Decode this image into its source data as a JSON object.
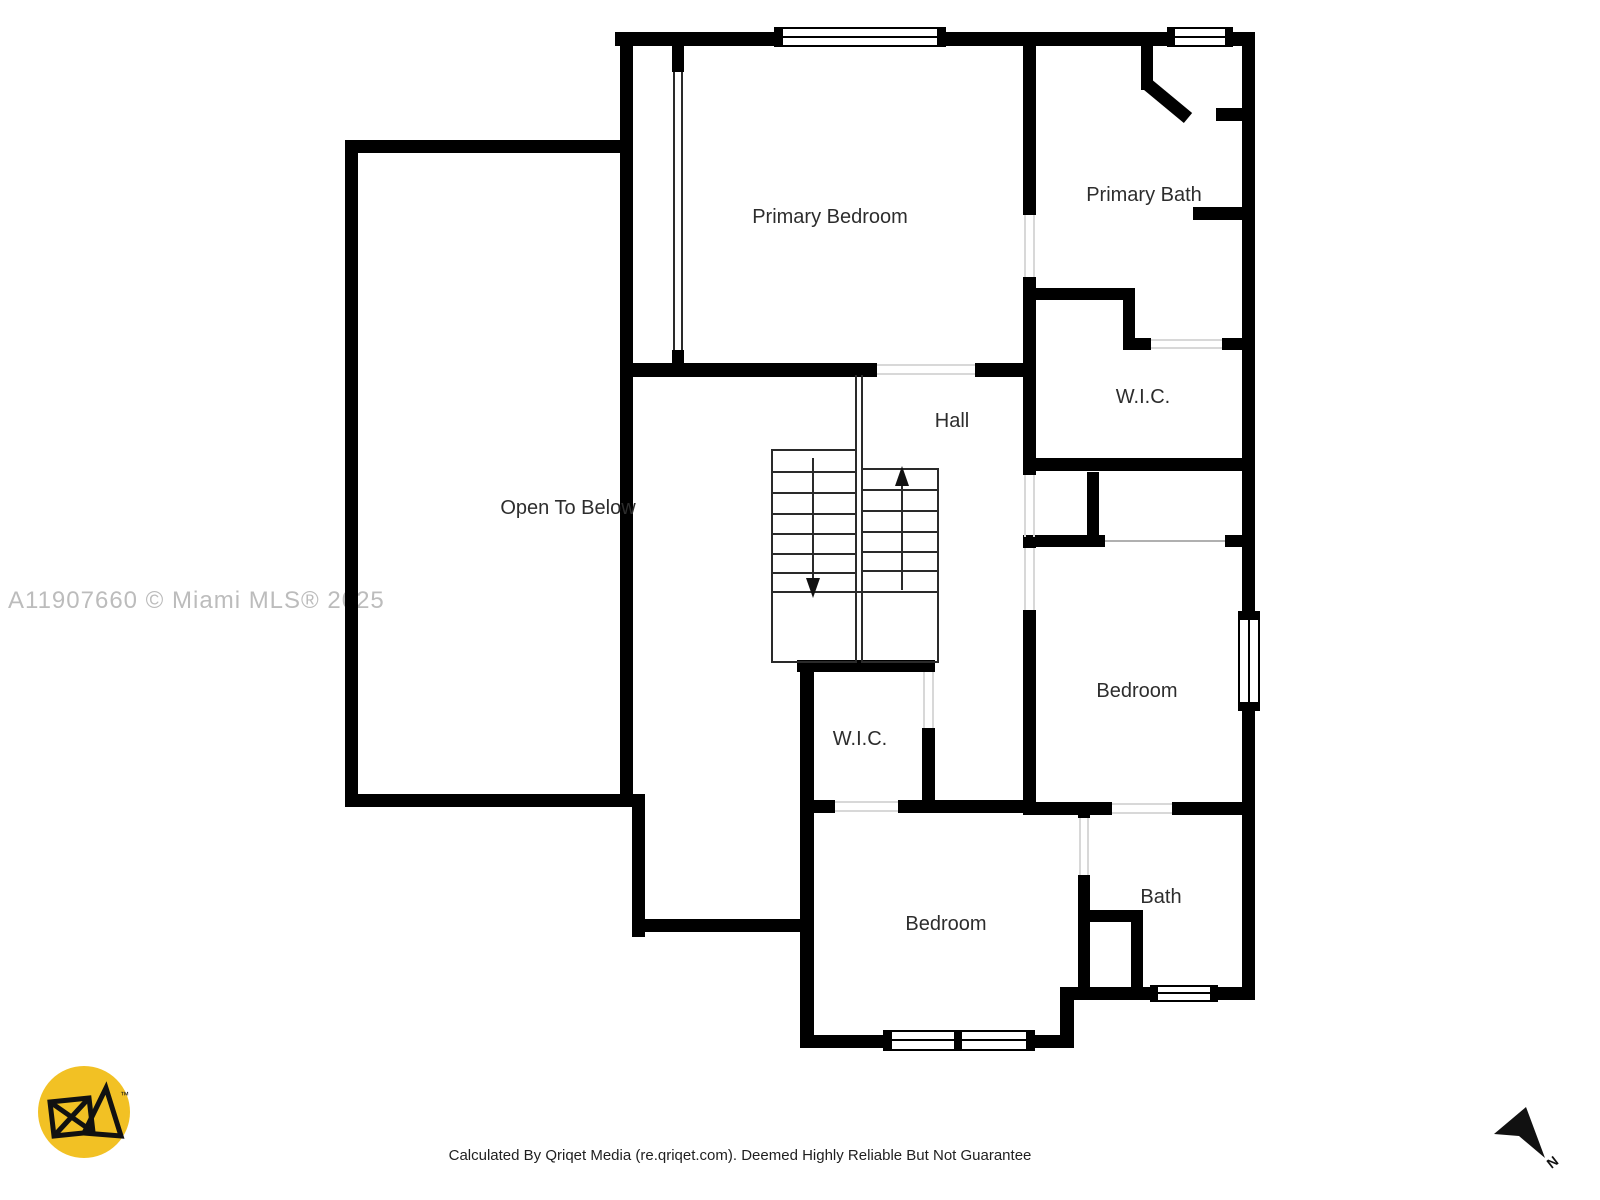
{
  "page": {
    "background": "#ffffff"
  },
  "floor_plan": {
    "wall_color": "#000000",
    "label_color": "#2d2d2d",
    "stair_line_color": "#2a2a2a",
    "opening_line_color": "#d8d8d8",
    "rooms": [
      {
        "id": "primary-bedroom",
        "label": "Primary Bedroom"
      },
      {
        "id": "primary-bath",
        "label": "Primary Bath"
      },
      {
        "id": "wic-upper",
        "label": "W.I.C."
      },
      {
        "id": "hall",
        "label": "Hall"
      },
      {
        "id": "open-to-below",
        "label": "Open To Below"
      },
      {
        "id": "wic-middle",
        "label": "W.I.C."
      },
      {
        "id": "bedroom-right",
        "label": "Bedroom"
      },
      {
        "id": "bedroom-lower",
        "label": "Bedroom"
      },
      {
        "id": "bath",
        "label": "Bath"
      }
    ]
  },
  "watermark": {
    "text": "A11907660 © Miami MLS® 2025",
    "color": "#bcbcbc"
  },
  "footer": {
    "text": "Calculated By Qriqet Media (re.qriqet.com). Deemed Highly Reliable But Not Guarantee",
    "color": "#1f1f1f"
  },
  "compass": {
    "label": "N",
    "color": "#111111"
  },
  "logo": {
    "trademark_symbol": "™",
    "background": "#F2C124",
    "mark_color": "#111111"
  }
}
